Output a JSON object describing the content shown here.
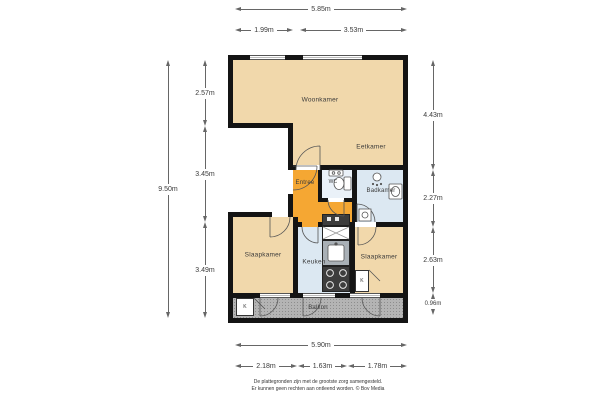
{
  "colors": {
    "wall": "#141414",
    "tan": "#f1d8ab",
    "orange": "#f5a733",
    "blue": "#dce8f2",
    "bluelight": "#eaf1f8",
    "balcony": "#b4b4b4",
    "counter": "#a9b0b6",
    "dim": "#666666",
    "ink": "#3a3a3a",
    "line": "#555555"
  },
  "rooms": {
    "woonkamer": "Woonkamer",
    "eetkamer": "Eetkamer",
    "entree": "Entree",
    "wc": "WC",
    "badkamer": "Badkamer",
    "slaapkamer_links": "Slaapkamer",
    "keuken": "Keuken",
    "slaapkamer_rechts": "Slaapkamer",
    "balkon": "Balkon",
    "kast": "K"
  },
  "dims": {
    "top_total": "5.85m",
    "top_a": "1.99m",
    "top_b": "3.53m",
    "left_total": "9.50m",
    "left_a": "2.57m",
    "left_b": "3.45m",
    "left_c": "3.49m",
    "right_a": "4.43m",
    "right_b": "2.27m",
    "right_c": "2.63m",
    "right_d": "0.96m",
    "bottom_total": "5.90m",
    "bottom_a": "2.18m",
    "bottom_b": "1.63m",
    "bottom_c": "1.78m"
  },
  "footer": {
    "line1": "De plattegronden zijn met de grootste zorg samengesteld.",
    "line2": "Er kunnen geen rechten aan ontleend worden. © Bov Media"
  }
}
